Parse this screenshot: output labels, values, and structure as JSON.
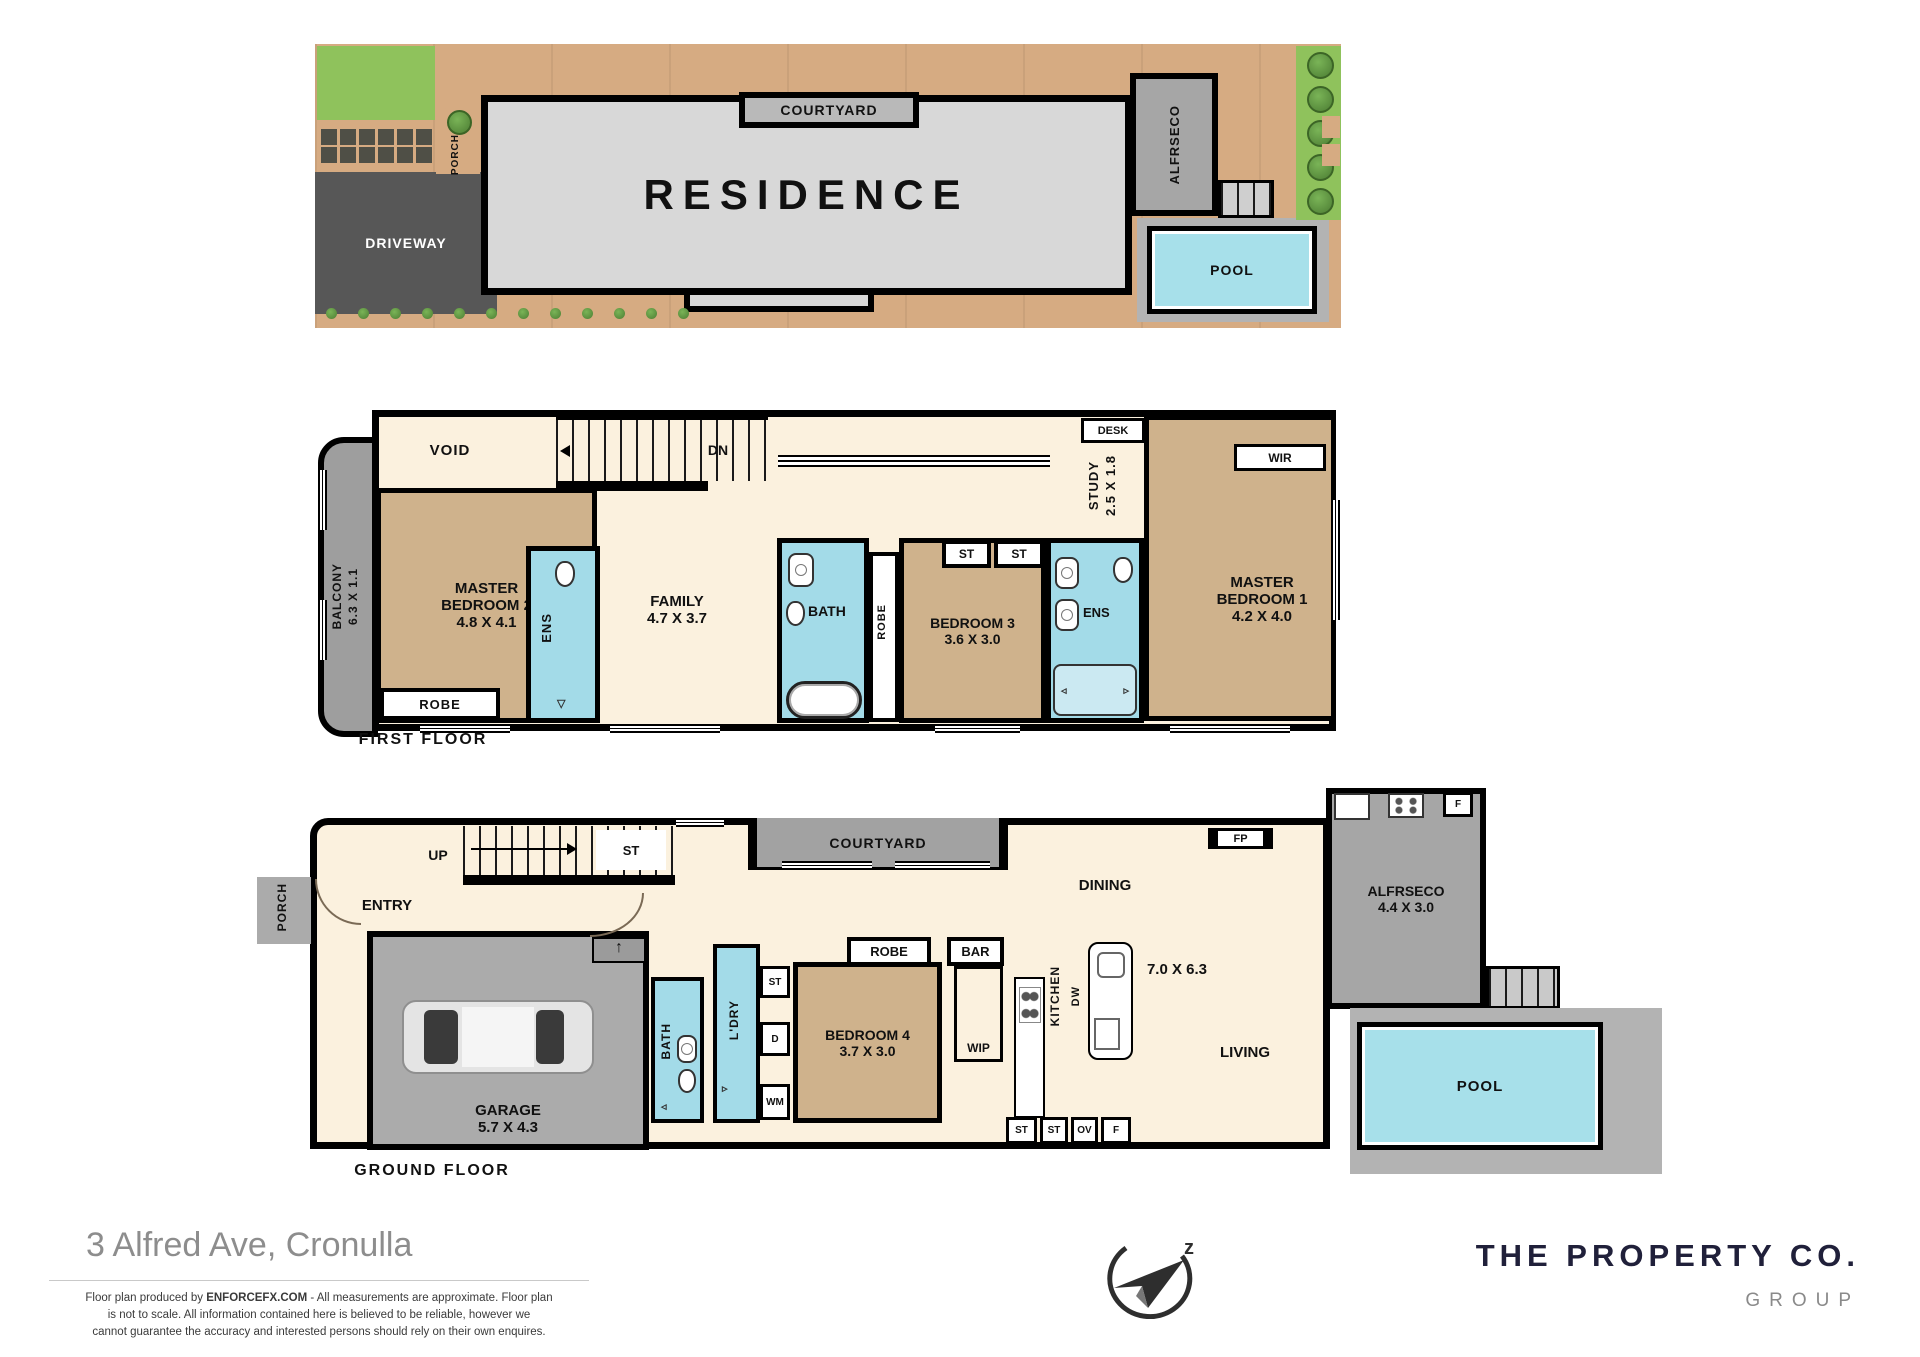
{
  "site": {
    "courtyard": "COURTYARD",
    "residence": "RESIDENCE",
    "alfresco": "ALFRSECO",
    "pool": "POOL",
    "porch": "PORCH",
    "driveway": "DRIVEWAY"
  },
  "ff": {
    "title": "FIRST FLOOR",
    "void": "VOID",
    "dn": "DN",
    "balcony_name": "BALCONY",
    "balcony_dims": "6.3 X 1.1",
    "mb2_l1": "MASTER",
    "mb2_l2": "BEDROOM 2",
    "mb2_dims": "4.8 X 4.1",
    "robe_mb2": "ROBE",
    "ens_left": "ENS",
    "family_name": "FAMILY",
    "family_dims": "4.7 X 3.7",
    "bath": "BATH",
    "robe_strip": "ROBE",
    "bed3_name": "BEDROOM 3",
    "bed3_dims": "3.6 X 3.0",
    "st1": "ST",
    "st2": "ST",
    "ens_right": "ENS",
    "study_name": "STUDY",
    "study_dims": "2.5 X 1.8",
    "desk_top": "DESK",
    "desk_side": "DESK",
    "wir": "WIR",
    "mb1_l1": "MASTER",
    "mb1_l2": "BEDROOM 1",
    "mb1_dims": "4.2 X 4.0"
  },
  "gf": {
    "title": "GROUND FLOOR",
    "porch": "PORCH",
    "entry": "ENTRY",
    "up": "UP",
    "st_stairs": "ST",
    "garage_name": "GARAGE",
    "garage_dims": "5.7 X 4.3",
    "bath": "BATH",
    "laundry": "L'DRY",
    "st_box": "ST",
    "d_box": "D",
    "wm_box": "WM",
    "bed4_name": "BEDROOM 4",
    "bed4_dims": "3.7 X 3.0",
    "robe": "ROBE",
    "bar": "BAR",
    "wip": "WIP",
    "kitchen": "KITCHEN",
    "dw": "DW",
    "open_dims": "7.0 X 6.3",
    "courtyard": "COURTYARD",
    "dining": "DINING",
    "fp": "FP",
    "living": "LIVING",
    "st_a": "ST",
    "st_b": "ST",
    "ov": "OV",
    "f_kitchen": "F",
    "alfresco_name": "ALFRSECO",
    "alfresco_dims": "4.4 X 3.0",
    "f_alfresco": "F",
    "pool": "POOL"
  },
  "footer": {
    "address": "3 Alfred Ave, Cronulla",
    "disc1_pre": "Floor plan produced by ",
    "disc1_brand": "ENFORCEFX.COM",
    "disc1_post": " - All  measurements are approximate. Floor plan",
    "disc2": "is not to scale. All information contained here is believed to be reliable, however we",
    "disc3": "cannot guarantee the accuracy and interested persons should rely on their own enquires.",
    "brand": "THE PROPERTY CO.",
    "brand_sub": "GROUP"
  },
  "colors": {
    "wall": "#000000",
    "cream": "#fbf1de",
    "tan": "#cfb28c",
    "cyan": "#a3dbe8",
    "gray_room": "#a9a9a9",
    "garage_gray": "#ababab",
    "driveway": "#575757",
    "paver": "#d6ab82",
    "grass": "#8fc25c",
    "pool": "#a7e0ea",
    "residence": "#d8d8d8",
    "brand_dark": "#20203a"
  }
}
